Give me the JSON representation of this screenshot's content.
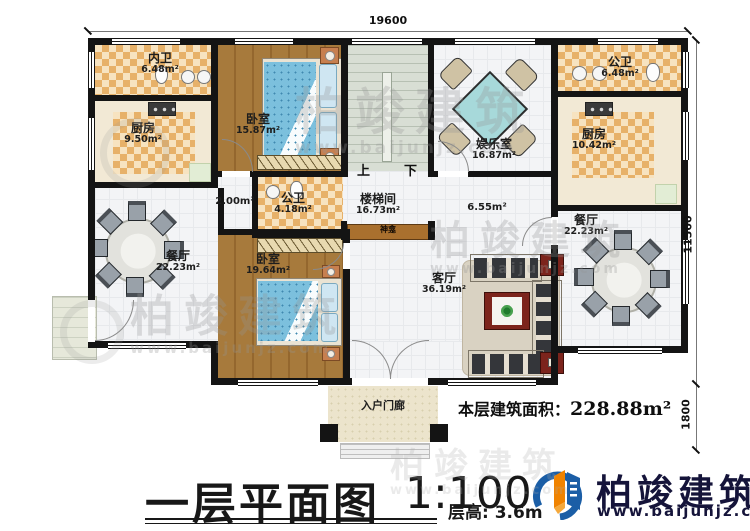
{
  "dims": {
    "width_top": "19600",
    "height_main": "11500",
    "height_porch": "1800"
  },
  "rooms": {
    "inner_bath": {
      "name": "内卫",
      "area": "6.48m²"
    },
    "kitchen_left": {
      "name": "厨房",
      "area": "9.50m²"
    },
    "bedroom_top": {
      "name": "卧室",
      "area": "15.87m²"
    },
    "public_bath_center": {
      "name": "公卫",
      "area": "4.18m²"
    },
    "stairwell": {
      "name": "楼梯间",
      "area": "16.73m²"
    },
    "entertainment": {
      "name": "娱乐室",
      "area": "16.87m²"
    },
    "public_bath_right": {
      "name": "公卫",
      "area": "6.48m²"
    },
    "kitchen_right": {
      "name": "厨房",
      "area": "10.42m²"
    },
    "dining_left": {
      "name": "餐厅",
      "area": "22.23m²"
    },
    "bedroom_bottom": {
      "name": "卧室",
      "area": "19.64m²"
    },
    "living": {
      "name": "客厅",
      "area": "36.19m²"
    },
    "dining_right": {
      "name": "餐厅",
      "area": "22.23m²"
    },
    "entry_porch": {
      "name": "入户门廊"
    },
    "shrine": {
      "name": "神龛"
    }
  },
  "annotations": {
    "corridor_small": "2.00m²",
    "hall": "6.55m²",
    "up": "上",
    "down": "下",
    "floor_area_label": "本层建筑面积：",
    "floor_area_value": "228.88m²"
  },
  "title": {
    "main": "一层平面图",
    "scale": "1:100",
    "floor_height": "层高: 3.6m"
  },
  "brand": {
    "name": "柏竣建筑",
    "url": "www.baijunjz.com"
  },
  "watermark": {
    "name": "柏竣建筑",
    "url": "www.baijunjz.com"
  },
  "colors": {
    "wall": "#141414",
    "checker_tile": "#e7b169",
    "wood_floor": "#a77a3c",
    "bed": "#7cc0dd",
    "brand_blue": "#1b5ea6",
    "brand_orange": "#f08300"
  }
}
